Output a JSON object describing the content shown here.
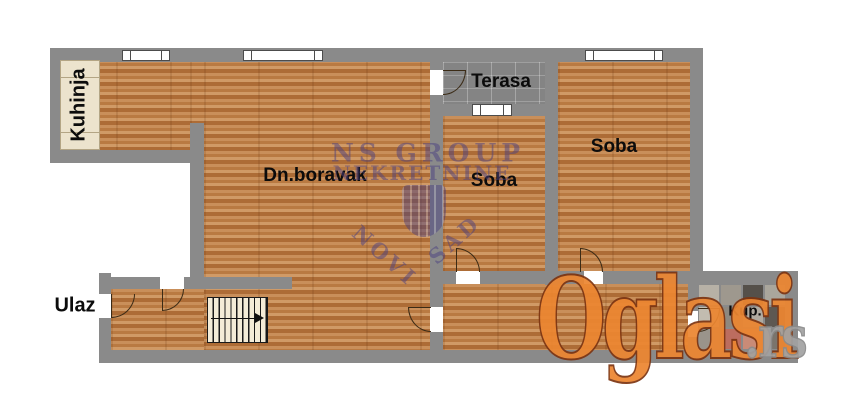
{
  "plan_title": "apartment-floor-plan",
  "rooms": {
    "kuhinja": {
      "label": "Kuhinja"
    },
    "dn_boravak": {
      "label": "Dn.boravak"
    },
    "terasa": {
      "label": "Terasa"
    },
    "soba_mid": {
      "label": "Soba"
    },
    "soba_right": {
      "label": "Soba"
    },
    "ulaz": {
      "label": "Ulaz"
    },
    "kupatilo": {
      "label": "Kup."
    }
  },
  "watermarks": {
    "agency": {
      "line1": "NS GROUP",
      "line2": "NEKRETNINE",
      "city_left": "NOVI",
      "city_right": "SAD"
    },
    "site": {
      "name": "Oglasi",
      "tld": ".rs"
    }
  },
  "colors": {
    "wall": "#8a8a8a",
    "floor_wood": "#bf8148",
    "terrace": "#848484",
    "kitchen_counter": "#ece3cd",
    "stairs_fill": "#f4ecd7",
    "label_text": "#0c0c0c",
    "agency_watermark": "#4c4181",
    "oglasi_orange": "#ec8631",
    "oglasi_outline": "#7d3512",
    "rs_gray": "#a2a2a2",
    "background": "#ffffff"
  },
  "bathroom": {
    "tiles": [
      "#b7b1a6",
      "#9e988e",
      "#55504a",
      "#aaa69c",
      "#c2bcb0",
      "#8e887f",
      "#b0aaa0",
      "#5e5852",
      "#9a948b",
      "#bc6d5f",
      "#c98b77",
      "#7a746c"
    ]
  }
}
